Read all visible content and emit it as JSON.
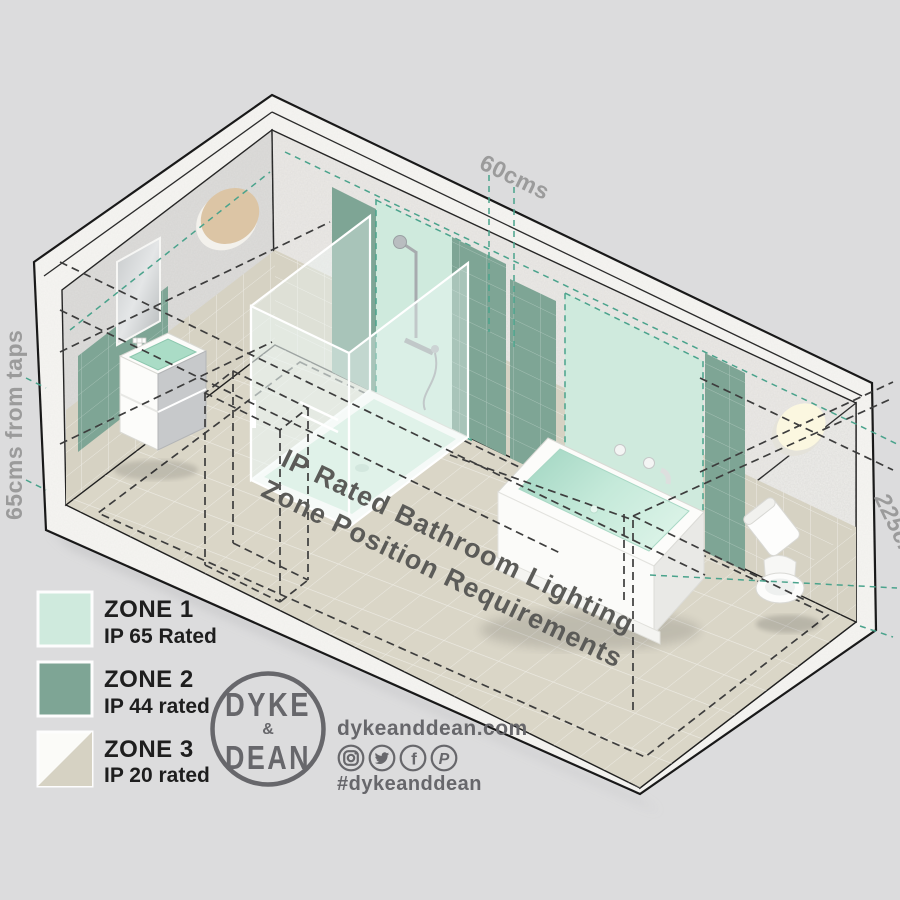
{
  "title": "IP Rated Bathroom Lighting Zone Position Requirements",
  "colors": {
    "background": "#dcdcdd",
    "zone1": "#cfeadd",
    "zone2": "#7ea595",
    "zone3_tile": "#d6d2c3",
    "floor": "#dad6c7",
    "teal_dash": "#4aa38c",
    "black_dash": "#3d3d3d",
    "text_gray": "#9b9b9b",
    "logo_gray": "#67676b",
    "ink": "#1e1e1e"
  },
  "measurements": {
    "top": "60cms",
    "left": "65cms from taps",
    "right": "225cms"
  },
  "floor_label": {
    "line1": "IP Rated Bathroom Lighting",
    "line2": "Zone Position Requirements"
  },
  "legend": {
    "items": [
      {
        "name": "ZONE 1",
        "rating": "IP 65 Rated",
        "color": "#cfeadd"
      },
      {
        "name": "ZONE 2",
        "rating": "IP 44 rated",
        "color": "#7ea595"
      },
      {
        "name": "ZONE 3",
        "rating": "IP 20 rated",
        "color": "#d6d2c3"
      }
    ]
  },
  "brand": {
    "logo_line1": "DYKE",
    "logo_amp": "&",
    "logo_line2": "DEAN",
    "website": "dykeanddean.com",
    "hashtag": "#dykeanddean",
    "social": [
      "instagram",
      "twitter",
      "facebook",
      "pinterest"
    ],
    "facebook_glyph": "f",
    "pinterest_glyph": "P"
  }
}
